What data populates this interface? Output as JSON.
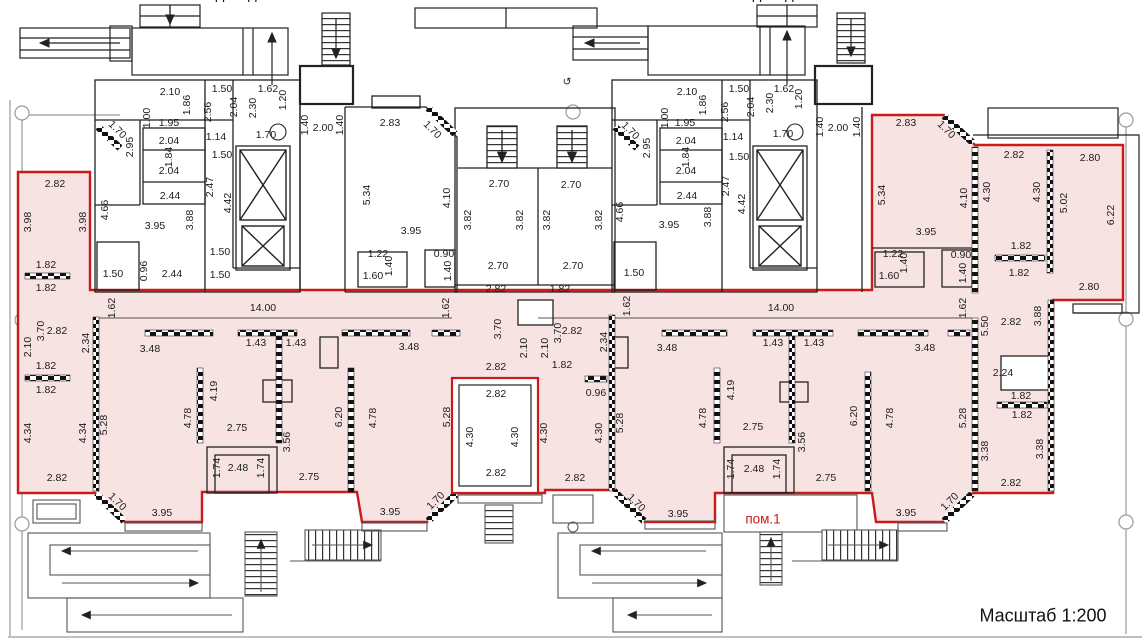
{
  "title": "Поэтажный план — пом.1",
  "scale_note": "Масштаб 1:200",
  "premise_label": "пом.1",
  "entrance_left_label": "Подъезд 2",
  "entrance_right_label": "Подъезд 1",
  "colors": {
    "premise_fill": "#f8e3e3",
    "premise_outline": "#cb1a1a",
    "walls": "#1c1c1c",
    "guides": "#8a8a8a"
  },
  "dims": [
    {
      "t": "2.10",
      "x": 170,
      "y": 92,
      "r": 0
    },
    {
      "t": "1.50",
      "x": 222,
      "y": 89,
      "r": 0
    },
    {
      "t": "1.62",
      "x": 268,
      "y": 89,
      "r": 0
    },
    {
      "t": "1.86",
      "x": 187,
      "y": 105,
      "r": -90
    },
    {
      "t": "1.00",
      "x": 147,
      "y": 118,
      "r": -90
    },
    {
      "t": "2.56",
      "x": 208,
      "y": 112,
      "r": -90
    },
    {
      "t": "2.04",
      "x": 234,
      "y": 107,
      "r": -90
    },
    {
      "t": "2.30",
      "x": 253,
      "y": 108,
      "r": -90
    },
    {
      "t": "1.20",
      "x": 283,
      "y": 100,
      "r": -90
    },
    {
      "t": "1.95",
      "x": 169,
      "y": 123,
      "r": 0
    },
    {
      "t": "2.95",
      "x": 130,
      "y": 147,
      "r": -90
    },
    {
      "t": "2.04",
      "x": 169,
      "y": 141,
      "r": 0
    },
    {
      "t": "1.84",
      "x": 169,
      "y": 157,
      "r": -90
    },
    {
      "t": "2.04",
      "x": 169,
      "y": 171,
      "r": 0
    },
    {
      "t": "2.44",
      "x": 170,
      "y": 196,
      "r": 0
    },
    {
      "t": "1.14",
      "x": 216,
      "y": 137,
      "r": 0
    },
    {
      "t": "1.50",
      "x": 222,
      "y": 155,
      "r": 0
    },
    {
      "t": "1.70",
      "x": 266,
      "y": 135,
      "r": 0
    },
    {
      "t": "1.40",
      "x": 305,
      "y": 125,
      "r": -90
    },
    {
      "t": "2.00",
      "x": 323,
      "y": 128,
      "r": 0
    },
    {
      "t": "1.40",
      "x": 340,
      "y": 125,
      "r": -90
    },
    {
      "t": "1.70",
      "x": 117,
      "y": 130,
      "r": 45
    },
    {
      "t": "2.47",
      "x": 210,
      "y": 187,
      "r": -90
    },
    {
      "t": "4.42",
      "x": 228,
      "y": 203,
      "r": -90
    },
    {
      "t": "3.88",
      "x": 190,
      "y": 220,
      "r": -90
    },
    {
      "t": "3.95",
      "x": 155,
      "y": 226,
      "r": 0
    },
    {
      "t": "4.66",
      "x": 105,
      "y": 210,
      "r": -90
    },
    {
      "t": "1.50",
      "x": 113,
      "y": 274,
      "r": 0
    },
    {
      "t": "0.96",
      "x": 144,
      "y": 271,
      "r": -90
    },
    {
      "t": "2.44",
      "x": 172,
      "y": 274,
      "r": 0
    },
    {
      "t": "1.50",
      "x": 220,
      "y": 252,
      "r": 0
    },
    {
      "t": "1.50",
      "x": 220,
      "y": 275,
      "r": 0
    },
    {
      "t": "2.82",
      "x": 55,
      "y": 184,
      "r": 0
    },
    {
      "t": "3.98",
      "x": 28,
      "y": 222,
      "r": -90
    },
    {
      "t": "3.98",
      "x": 83,
      "y": 222,
      "r": -90
    },
    {
      "t": "1.82",
      "x": 46,
      "y": 265,
      "r": 0
    },
    {
      "t": "1.82",
      "x": 46,
      "y": 288,
      "r": 0
    },
    {
      "t": "2.83",
      "x": 390,
      "y": 123,
      "r": 0
    },
    {
      "t": "1.70",
      "x": 432,
      "y": 130,
      "r": 45
    },
    {
      "t": "5.34",
      "x": 367,
      "y": 195,
      "r": -90
    },
    {
      "t": "4.10",
      "x": 447,
      "y": 198,
      "r": -90
    },
    {
      "t": "3.95",
      "x": 411,
      "y": 231,
      "r": 0
    },
    {
      "t": "1.22",
      "x": 378,
      "y": 254,
      "r": 0
    },
    {
      "t": "1.40",
      "x": 389,
      "y": 266,
      "r": -90
    },
    {
      "t": "1.60",
      "x": 373,
      "y": 276,
      "r": 0
    },
    {
      "t": "0.90",
      "x": 444,
      "y": 254,
      "r": 0
    },
    {
      "t": "1.40",
      "x": 448,
      "y": 271,
      "r": -90
    },
    {
      "t": "2.70",
      "x": 499,
      "y": 184,
      "r": 0
    },
    {
      "t": "2.70",
      "x": 571,
      "y": 185,
      "r": 0
    },
    {
      "t": "3.82",
      "x": 468,
      "y": 220,
      "r": -90
    },
    {
      "t": "3.82",
      "x": 520,
      "y": 220,
      "r": -90
    },
    {
      "t": "3.82",
      "x": 547,
      "y": 220,
      "r": -90
    },
    {
      "t": "3.82",
      "x": 599,
      "y": 220,
      "r": -90
    },
    {
      "t": "2.70",
      "x": 498,
      "y": 266,
      "r": 0
    },
    {
      "t": "2.70",
      "x": 573,
      "y": 266,
      "r": 0
    },
    {
      "t": "4.66",
      "x": 620,
      "y": 212,
      "r": -90
    },
    {
      "t": "1.50",
      "x": 634,
      "y": 273,
      "r": 0
    },
    {
      "t": "1.70",
      "x": 630,
      "y": 131,
      "r": 45
    },
    {
      "t": "2.10",
      "x": 687,
      "y": 92,
      "r": 0
    },
    {
      "t": "1.50",
      "x": 739,
      "y": 89,
      "r": 0
    },
    {
      "t": "1.62",
      "x": 784,
      "y": 89,
      "r": 0
    },
    {
      "t": "1.86",
      "x": 703,
      "y": 105,
      "r": -90
    },
    {
      "t": "1.00",
      "x": 665,
      "y": 118,
      "r": -90
    },
    {
      "t": "2.56",
      "x": 725,
      "y": 112,
      "r": -90
    },
    {
      "t": "2.04",
      "x": 751,
      "y": 107,
      "r": -90
    },
    {
      "t": "2.30",
      "x": 770,
      "y": 103,
      "r": -90
    },
    {
      "t": "1.20",
      "x": 799,
      "y": 99,
      "r": -90
    },
    {
      "t": "1.95",
      "x": 685,
      "y": 123,
      "r": 0
    },
    {
      "t": "2.95",
      "x": 647,
      "y": 148,
      "r": -90
    },
    {
      "t": "2.04",
      "x": 686,
      "y": 141,
      "r": 0
    },
    {
      "t": "1.84",
      "x": 686,
      "y": 157,
      "r": -90
    },
    {
      "t": "2.04",
      "x": 686,
      "y": 171,
      "r": 0
    },
    {
      "t": "2.44",
      "x": 687,
      "y": 196,
      "r": 0
    },
    {
      "t": "1.14",
      "x": 733,
      "y": 137,
      "r": 0
    },
    {
      "t": "1.50",
      "x": 739,
      "y": 157,
      "r": 0
    },
    {
      "t": "1.70",
      "x": 783,
      "y": 134,
      "r": 0
    },
    {
      "t": "1.40",
      "x": 820,
      "y": 127,
      "r": -90
    },
    {
      "t": "2.00",
      "x": 838,
      "y": 128,
      "r": 0
    },
    {
      "t": "1.40",
      "x": 857,
      "y": 127,
      "r": -90
    },
    {
      "t": "2.47",
      "x": 726,
      "y": 186,
      "r": -90
    },
    {
      "t": "4.42",
      "x": 742,
      "y": 204,
      "r": -90
    },
    {
      "t": "3.88",
      "x": 708,
      "y": 217,
      "r": -90
    },
    {
      "t": "3.95",
      "x": 669,
      "y": 225,
      "r": 0
    },
    {
      "t": "2.83",
      "x": 906,
      "y": 123,
      "r": 0
    },
    {
      "t": "1.70",
      "x": 946,
      "y": 130,
      "r": 45
    },
    {
      "t": "5.34",
      "x": 882,
      "y": 195,
      "r": -90
    },
    {
      "t": "4.10",
      "x": 964,
      "y": 198,
      "r": -90
    },
    {
      "t": "3.95",
      "x": 926,
      "y": 232,
      "r": 0
    },
    {
      "t": "1.22",
      "x": 893,
      "y": 254,
      "r": 0
    },
    {
      "t": "1.40",
      "x": 904,
      "y": 263,
      "r": -90
    },
    {
      "t": "1.60",
      "x": 889,
      "y": 276,
      "r": 0
    },
    {
      "t": "0.90",
      "x": 961,
      "y": 255,
      "r": 0
    },
    {
      "t": "1.40",
      "x": 963,
      "y": 273,
      "r": -90
    },
    {
      "t": "2.82",
      "x": 1014,
      "y": 155,
      "r": 0
    },
    {
      "t": "4.30",
      "x": 987,
      "y": 192,
      "r": -90
    },
    {
      "t": "4.30",
      "x": 1037,
      "y": 192,
      "r": -90
    },
    {
      "t": "2.80",
      "x": 1090,
      "y": 158,
      "r": 0
    },
    {
      "t": "5.02",
      "x": 1064,
      "y": 203,
      "r": -90
    },
    {
      "t": "6.22",
      "x": 1111,
      "y": 215,
      "r": -90
    },
    {
      "t": "1.82",
      "x": 1021,
      "y": 246,
      "r": 0
    },
    {
      "t": "1.82",
      "x": 1019,
      "y": 273,
      "r": 0
    },
    {
      "t": "2.80",
      "x": 1089,
      "y": 287,
      "r": 0
    },
    {
      "t": "1.62",
      "x": 112,
      "y": 308,
      "r": -90
    },
    {
      "t": "14.00",
      "x": 263,
      "y": 308,
      "r": 0
    },
    {
      "t": "1.62",
      "x": 446,
      "y": 308,
      "r": -90
    },
    {
      "t": "2.82",
      "x": 496,
      "y": 289,
      "r": 0
    },
    {
      "t": "1.82",
      "x": 560,
      "y": 289,
      "r": 0
    },
    {
      "t": "1.62",
      "x": 627,
      "y": 306,
      "r": -90
    },
    {
      "t": "14.00",
      "x": 781,
      "y": 308,
      "r": 0
    },
    {
      "t": "1.62",
      "x": 963,
      "y": 308,
      "r": -90
    },
    {
      "t": "2.82",
      "x": 57,
      "y": 331,
      "r": 0
    },
    {
      "t": "3.70",
      "x": 41,
      "y": 331,
      "r": -90
    },
    {
      "t": "2.10",
      "x": 28,
      "y": 347,
      "r": -90
    },
    {
      "t": "2.34",
      "x": 86,
      "y": 343,
      "r": -90
    },
    {
      "t": "3.48",
      "x": 150,
      "y": 349,
      "r": 0
    },
    {
      "t": "1.43",
      "x": 256,
      "y": 343,
      "r": 0
    },
    {
      "t": "1.43",
      "x": 296,
      "y": 343,
      "r": 0
    },
    {
      "t": "1.82",
      "x": 46,
      "y": 366,
      "r": 0
    },
    {
      "t": "1.82",
      "x": 46,
      "y": 390,
      "r": 0
    },
    {
      "t": "4.34",
      "x": 28,
      "y": 433,
      "r": -90
    },
    {
      "t": "4.34",
      "x": 83,
      "y": 433,
      "r": -90
    },
    {
      "t": "5.28",
      "x": 104,
      "y": 425,
      "r": -90
    },
    {
      "t": "3.48",
      "x": 409,
      "y": 347,
      "r": 0
    },
    {
      "t": "4.78",
      "x": 188,
      "y": 418,
      "r": -90
    },
    {
      "t": "4.19",
      "x": 214,
      "y": 391,
      "r": -90
    },
    {
      "t": "2.75",
      "x": 237,
      "y": 428,
      "r": 0
    },
    {
      "t": "2.48",
      "x": 238,
      "y": 468,
      "r": 0
    },
    {
      "t": "1.74",
      "x": 217,
      "y": 468,
      "r": -90
    },
    {
      "t": "1.74",
      "x": 261,
      "y": 468,
      "r": -90
    },
    {
      "t": "3.56",
      "x": 287,
      "y": 442,
      "r": -90
    },
    {
      "t": "2.82",
      "x": 57,
      "y": 478,
      "r": 0
    },
    {
      "t": "1.70",
      "x": 117,
      "y": 502,
      "r": 45
    },
    {
      "t": "3.95",
      "x": 162,
      "y": 513,
      "r": 0
    },
    {
      "t": "6.20",
      "x": 339,
      "y": 417,
      "r": -90
    },
    {
      "t": "4.78",
      "x": 373,
      "y": 418,
      "r": -90
    },
    {
      "t": "2.75",
      "x": 309,
      "y": 477,
      "r": 0
    },
    {
      "t": "3.95",
      "x": 390,
      "y": 512,
      "r": 0
    },
    {
      "t": "1.70",
      "x": 436,
      "y": 501,
      "r": -45
    },
    {
      "t": "5.28",
      "x": 447,
      "y": 417,
      "r": -90
    },
    {
      "t": "3.70",
      "x": 498,
      "y": 329,
      "r": -90
    },
    {
      "t": "2.10",
      "x": 524,
      "y": 348,
      "r": -90
    },
    {
      "t": "2.10",
      "x": 545,
      "y": 348,
      "r": -90
    },
    {
      "t": "3.70",
      "x": 558,
      "y": 333,
      "r": -90
    },
    {
      "t": "2.82",
      "x": 496,
      "y": 367,
      "r": 0
    },
    {
      "t": "1.82",
      "x": 562,
      "y": 365,
      "r": 0
    },
    {
      "t": "2.82",
      "x": 496,
      "y": 394,
      "r": 0
    },
    {
      "t": "4.30",
      "x": 470,
      "y": 437,
      "r": -90
    },
    {
      "t": "4.30",
      "x": 515,
      "y": 437,
      "r": -90
    },
    {
      "t": "2.82",
      "x": 496,
      "y": 473,
      "r": 0
    },
    {
      "t": "4.30",
      "x": 544,
      "y": 433,
      "r": -90
    },
    {
      "t": "2.82",
      "x": 572,
      "y": 331,
      "r": 0
    },
    {
      "t": "0.96",
      "x": 596,
      "y": 393,
      "r": 0
    },
    {
      "t": "2.34",
      "x": 604,
      "y": 342,
      "r": -90
    },
    {
      "t": "4.30",
      "x": 599,
      "y": 433,
      "r": -90
    },
    {
      "t": "2.82",
      "x": 575,
      "y": 478,
      "r": 0
    },
    {
      "t": "3.48",
      "x": 667,
      "y": 348,
      "r": 0
    },
    {
      "t": "1.43",
      "x": 773,
      "y": 343,
      "r": 0
    },
    {
      "t": "1.43",
      "x": 814,
      "y": 343,
      "r": 0
    },
    {
      "t": "5.28",
      "x": 620,
      "y": 423,
      "r": -90
    },
    {
      "t": "4.78",
      "x": 703,
      "y": 418,
      "r": -90
    },
    {
      "t": "4.19",
      "x": 731,
      "y": 390,
      "r": -90
    },
    {
      "t": "2.75",
      "x": 753,
      "y": 427,
      "r": 0
    },
    {
      "t": "2.48",
      "x": 754,
      "y": 469,
      "r": 0
    },
    {
      "t": "1.74",
      "x": 731,
      "y": 469,
      "r": -90
    },
    {
      "t": "1.74",
      "x": 777,
      "y": 469,
      "r": -90
    },
    {
      "t": "3.56",
      "x": 802,
      "y": 442,
      "r": -90
    },
    {
      "t": "1.70",
      "x": 636,
      "y": 503,
      "r": 45
    },
    {
      "t": "3.95",
      "x": 678,
      "y": 514,
      "r": 0
    },
    {
      "t": "2.75",
      "x": 826,
      "y": 478,
      "r": 0
    },
    {
      "t": "6.20",
      "x": 854,
      "y": 416,
      "r": -90
    },
    {
      "t": "4.78",
      "x": 890,
      "y": 418,
      "r": -90
    },
    {
      "t": "3.48",
      "x": 925,
      "y": 348,
      "r": 0
    },
    {
      "t": "5.50",
      "x": 985,
      "y": 326,
      "r": -90
    },
    {
      "t": "2.82",
      "x": 1011,
      "y": 322,
      "r": 0
    },
    {
      "t": "3.88",
      "x": 1038,
      "y": 316,
      "r": -90
    },
    {
      "t": "2.24",
      "x": 1003,
      "y": 373,
      "r": 0
    },
    {
      "t": "1.82",
      "x": 1021,
      "y": 396,
      "r": 0
    },
    {
      "t": "1.82",
      "x": 1022,
      "y": 415,
      "r": 0
    },
    {
      "t": "5.28",
      "x": 963,
      "y": 418,
      "r": -90
    },
    {
      "t": "3.38",
      "x": 985,
      "y": 451,
      "r": -90
    },
    {
      "t": "3.38",
      "x": 1040,
      "y": 449,
      "r": -90
    },
    {
      "t": "2.82",
      "x": 1011,
      "y": 483,
      "r": 0
    },
    {
      "t": "3.95",
      "x": 906,
      "y": 513,
      "r": 0
    },
    {
      "t": "1.70",
      "x": 950,
      "y": 502,
      "r": -45
    },
    {
      "t": "↺",
      "x": 567,
      "y": 82,
      "r": 0
    }
  ]
}
